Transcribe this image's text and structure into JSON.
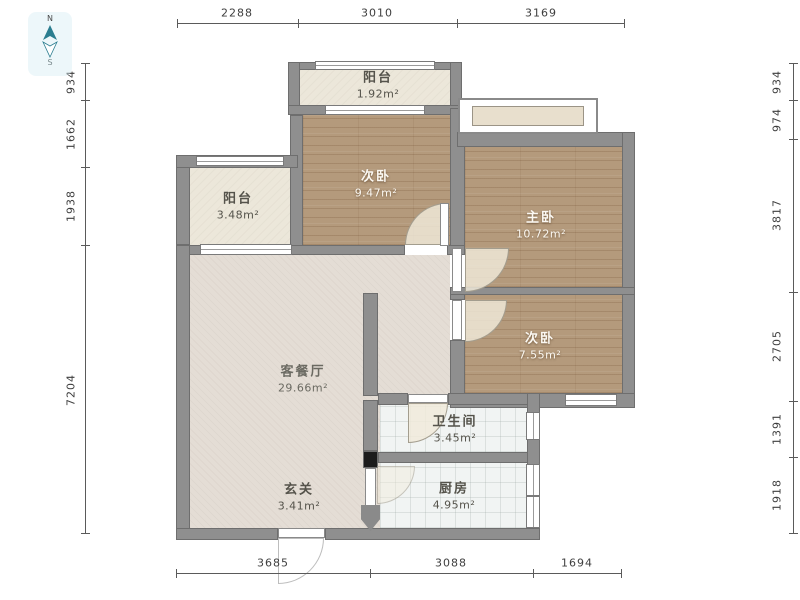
{
  "compass": {
    "north": "N",
    "south": "S"
  },
  "rooms": {
    "balcony_top": {
      "name": "阳台",
      "area": "1.92m²"
    },
    "bedroom_top": {
      "name": "次卧",
      "area": "9.47m²"
    },
    "master_bedroom": {
      "name": "主卧",
      "area": "10.72m²"
    },
    "balcony_left": {
      "name": "阳台",
      "area": "3.48m²"
    },
    "bedroom_right": {
      "name": "次卧",
      "area": "7.55m²"
    },
    "living_dining": {
      "name": "客餐厅",
      "area": "29.66m²"
    },
    "bathroom": {
      "name": "卫生间",
      "area": "3.45m²"
    },
    "entry": {
      "name": "玄关",
      "area": "3.41m²"
    },
    "kitchen": {
      "name": "厨房",
      "area": "4.95m²"
    }
  },
  "dimensions": {
    "top": [
      "2288",
      "3010",
      "3169"
    ],
    "bottom": [
      "3685",
      "3088",
      "1694"
    ],
    "left": [
      "934",
      "1662",
      "1938",
      "7204"
    ],
    "right": [
      "934",
      "974",
      "3817",
      "2705",
      "1391",
      "1918"
    ]
  },
  "colors": {
    "wall": "#8f8f8f",
    "wood_floor": "#b49a7c",
    "living_floor": "#e4ddd5",
    "balcony_floor": "#ece7da",
    "tile_floor": "#f1f4f3",
    "compass_teal": "#2b7e90"
  }
}
